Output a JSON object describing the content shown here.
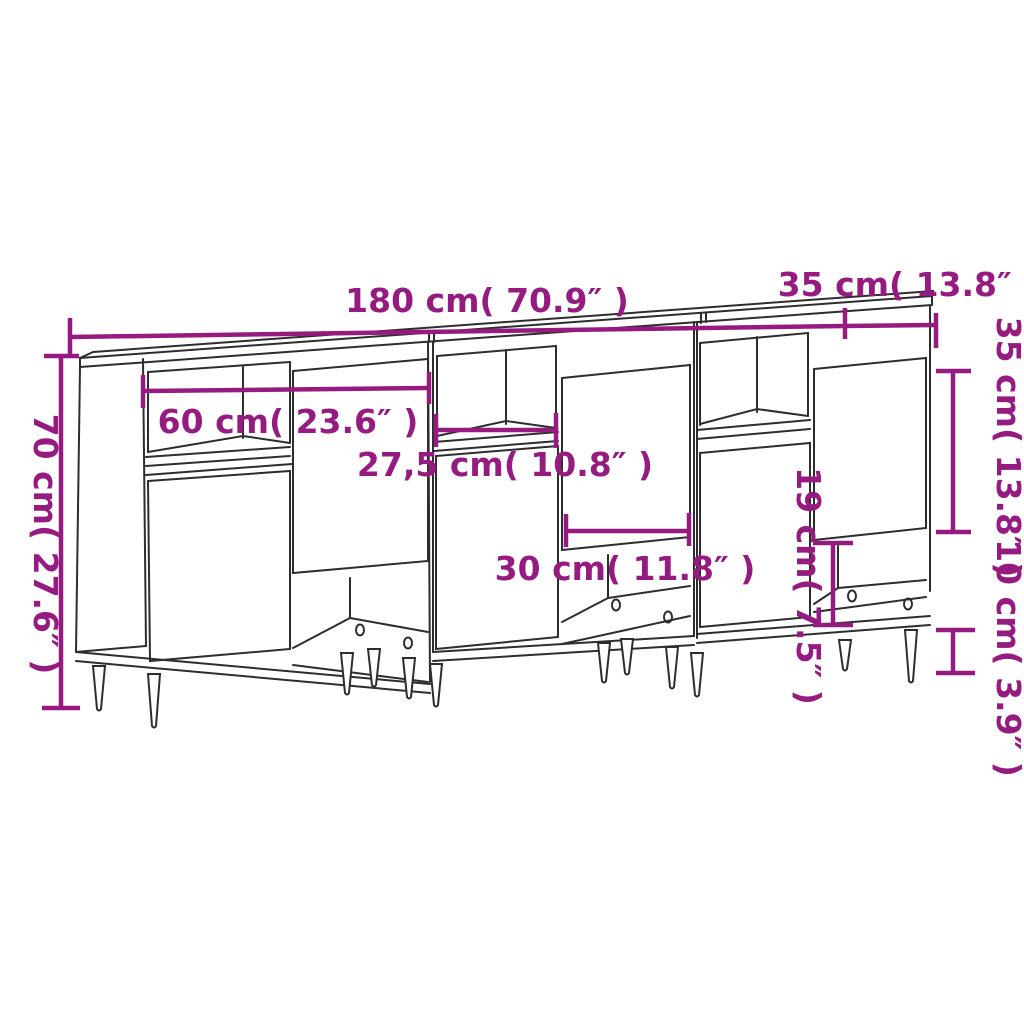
{
  "colors": {
    "dimension_accent": "#951b81",
    "outline": "#2d2d2d",
    "background": "#ffffff"
  },
  "diagram": {
    "labels": {
      "total_width": "180 cm( 70.9″ )",
      "depth": "35 cm( 13.8″ )",
      "total_height": "70 cm( 27.6″ )",
      "unit_width": "60 cm( 23.6″ )",
      "niche_width": "27,5 cm( 10.8″ )",
      "door_width": "30 cm( 11.8″ )",
      "open_compartment_height": "19 cm( 7.5″ )",
      "body_height": "35 cm( 13.8″ )",
      "leg_height": "10 cm( 3.9″ )"
    }
  }
}
